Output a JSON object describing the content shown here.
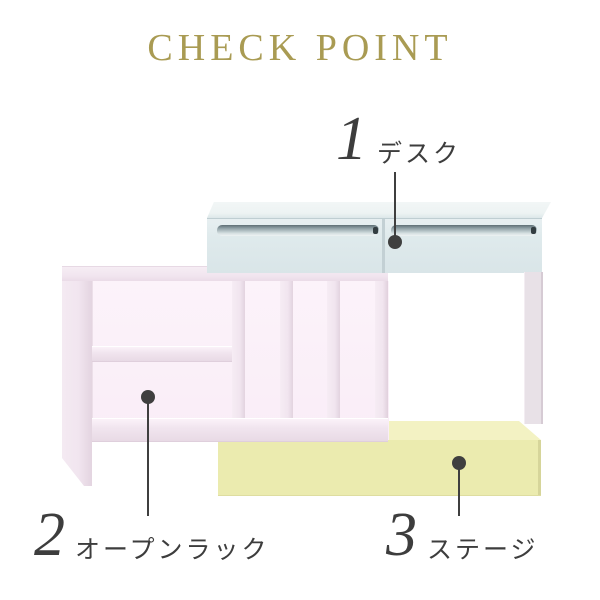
{
  "title": "CHECK POINT",
  "callouts": [
    {
      "number": "1",
      "label": "デスク",
      "part": "desk"
    },
    {
      "number": "2",
      "label": "オープンラック",
      "part": "open-rack"
    },
    {
      "number": "3",
      "label": "ステージ",
      "part": "stage"
    }
  ],
  "colors": {
    "title-gold": "#a99b53",
    "ink": "#3d3d3d",
    "marker": "#3f3f3f",
    "desk-top": "#edf3f3",
    "desk-front": "#dfeaec",
    "desk-edge": "#c3d0d4",
    "groove-dark": "#5e6e74",
    "groove-light": "#d5dfe1",
    "groove-cap": "#333d41",
    "leg": "#e8e1e7",
    "rack-face": "#f1e5ef",
    "rack-edge": "#dccdd9",
    "rack-interior": "#fcf3fa",
    "stage-top": "#f3f2c3",
    "stage-front": "#ebebaf"
  }
}
